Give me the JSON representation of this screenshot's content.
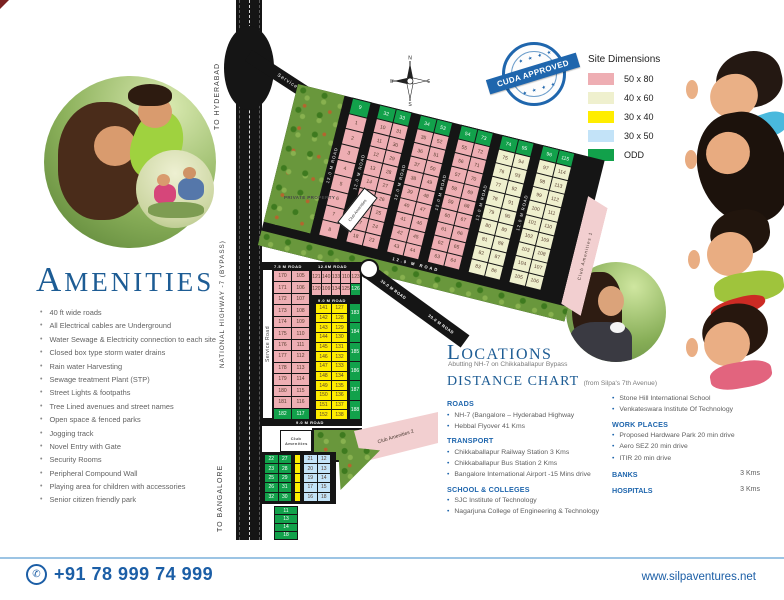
{
  "colors": {
    "pink": "#eeaeb3",
    "cream": "#eff0ce",
    "yellow": "#ffed00",
    "blue": "#c3e3f8",
    "green": "#12a14b",
    "road": "#151515",
    "accent": "#1f66ad",
    "heading": "#1d5c94"
  },
  "badge": {
    "text": "CUDA APPROVED",
    "stars": "★ ★ ★ ★"
  },
  "compass": {
    "n": "N",
    "e": "E",
    "s": "S",
    "w": "W"
  },
  "legend": {
    "title": "Site Dimensions",
    "items": [
      {
        "label": "50 x 80",
        "color": "#eeaeb3"
      },
      {
        "label": "40 x 60",
        "color": "#eff0ce"
      },
      {
        "label": "30 x 40",
        "color": "#ffed00"
      },
      {
        "label": "30 x 50",
        "color": "#c3e3f8"
      },
      {
        "label": "ODD",
        "color": "#12a14b"
      }
    ]
  },
  "amenities": {
    "title": "Amenities",
    "items": [
      "40 ft wide roads",
      "All Electrical cables are Underground",
      "Water Sewage & Electricity connection to each site",
      "Closed box type storm water drains",
      "Rain water Harvesting",
      "Sewage treatment Plant (STP)",
      "Street Lights & footpaths",
      "Tree Lined avenues and street names",
      "Open space & fenced parks",
      "Jogging track",
      "Novel Entry with Gate",
      "Security Rooms",
      "Peripheral Compound Wall",
      "Playing area for children with accessories",
      "Senior citizen friendly park"
    ]
  },
  "locations": {
    "title": "Locations",
    "subtitle": "Abutting NH-7 on Chikkaballapur Bypass"
  },
  "distance_chart": {
    "title": "Distance Chart",
    "subtitle": "(from Silpa's 7th Avenue)",
    "left_sections": [
      {
        "heading": "ROADS",
        "items": [
          "NH-7 (Bangalore – Hyderabad Highway",
          "Hebbal Flyover 41 Kms"
        ]
      },
      {
        "heading": "TRANSPORT",
        "items": [
          "Chikkaballapur Railway Station 3 Kms",
          "Chikkaballapur Bus Station 2 Kms",
          "Bangalore International Airport -15 Mins drive"
        ]
      },
      {
        "heading": "SCHOOL & COLLEGES",
        "items": [
          "SJC Institute of Technology",
          "Nagarjuna College of Engineering & Technology"
        ]
      }
    ],
    "right_sections": [
      {
        "heading": "",
        "items": [
          "Stone Hill International School",
          "Venkateswara Institute Of Technology"
        ]
      },
      {
        "heading": "WORK PLACES",
        "items": [
          "Proposed Hardware Park 20 min drive",
          "Aero SEZ 20 min drive",
          "ITIR  20 min drive"
        ]
      }
    ],
    "rows": [
      {
        "label": "BANKS",
        "value": "3 Kms"
      },
      {
        "label": "HOSPITALS",
        "value": "3 Kms"
      }
    ]
  },
  "map": {
    "labels": {
      "to_hyderabad": "TO HYDERABAD",
      "highway": "NATIONAL HIGHWAY -7 (BYPASS)",
      "to_bangalore": "TO BANGALORE",
      "service_road": "Service Road",
      "private_property": "PRIVATE PROPERTY",
      "club1": "Club Amenities 1",
      "club2": "Club Amenities 2",
      "club": "Club Amenities",
      "road_between": "12.0 M ROAD",
      "road_bottom_strip": "12.0 M ROAD",
      "road_top_a": "7.5 M ROAD",
      "road_top_b": "12.0M ROAD",
      "road_mid": "9.0 M ROAD",
      "road_low": "9.0 M ROAD",
      "road_diag": "30.0 M ROAD"
    },
    "upper_columns": [
      {
        "w": 20,
        "color": "pink",
        "head": [
          "9"
        ],
        "rows": [
          [
            "1"
          ],
          [
            "2"
          ],
          [
            "3"
          ],
          [
            "4"
          ],
          [
            "5"
          ],
          [
            "6"
          ],
          [
            "7"
          ],
          [
            "8"
          ]
        ]
      },
      {
        "w": 34,
        "color": "pink",
        "head": [
          "32",
          "33"
        ],
        "rows": [
          [
            "10",
            "31"
          ],
          [
            "11",
            "30"
          ],
          [
            "12",
            "29"
          ],
          [
            "13",
            "28"
          ],
          [
            "14",
            "27"
          ],
          [
            "15",
            "26"
          ],
          [
            "16",
            "25"
          ],
          [
            "17",
            "24"
          ],
          [
            "18",
            "23"
          ]
        ]
      },
      {
        "w": 34,
        "color": "pink",
        "head": [
          "34",
          "53"
        ],
        "rows": [
          [
            "35",
            "52"
          ],
          [
            "36",
            "51"
          ],
          [
            "37",
            "50"
          ],
          [
            "38",
            "49"
          ],
          [
            "39",
            "48"
          ],
          [
            "40",
            "47"
          ],
          [
            "41",
            "46"
          ],
          [
            "42",
            "45"
          ],
          [
            "43",
            "44"
          ]
        ]
      },
      {
        "w": 34,
        "color": "pink",
        "head": [
          "54",
          "73"
        ],
        "rows": [
          [
            "55",
            "72"
          ],
          [
            "56",
            "71"
          ],
          [
            "57",
            "70"
          ],
          [
            "58",
            "69"
          ],
          [
            "59",
            "68"
          ],
          [
            "60",
            "67"
          ],
          [
            "61",
            "66"
          ],
          [
            "62",
            "65"
          ],
          [
            "63",
            "64"
          ]
        ]
      },
      {
        "w": 34,
        "color": "cream",
        "head": [
          "74",
          "95"
        ],
        "rows": [
          [
            "75",
            "94"
          ],
          [
            "76",
            "93"
          ],
          [
            "77",
            "92"
          ],
          [
            "78",
            "91"
          ],
          [
            "79",
            "90"
          ],
          [
            "80",
            "89"
          ],
          [
            "81",
            "88"
          ],
          [
            "82",
            "87"
          ],
          [
            "83",
            "86"
          ]
        ]
      },
      {
        "w": 34,
        "color": "cream",
        "head": [
          "96",
          "115"
        ],
        "rows": [
          [
            "97",
            "114"
          ],
          [
            "98",
            "113"
          ],
          [
            "99",
            "112"
          ],
          [
            "100",
            "111"
          ],
          [
            "101",
            "110"
          ],
          [
            "102",
            "109"
          ],
          [
            "103",
            "108"
          ],
          [
            "104",
            "107"
          ],
          [
            "105",
            "106"
          ]
        ]
      }
    ],
    "lower": {
      "pink_rows": [
        [
          "170",
          "105"
        ],
        [
          "171",
          "106"
        ],
        [
          "172",
          "107"
        ],
        [
          "173",
          "108"
        ],
        [
          "174",
          "109"
        ],
        [
          "175",
          "110"
        ],
        [
          "176",
          "111"
        ],
        [
          "177",
          "112"
        ],
        [
          "178",
          "113"
        ],
        [
          "179",
          "114"
        ],
        [
          "180",
          "115"
        ],
        [
          "181",
          "116"
        ],
        [
          "182",
          "117"
        ]
      ],
      "mini_rows": [
        [
          "121",
          "140",
          "133",
          "110",
          "123"
        ],
        [
          "120",
          "109",
          "134",
          "125",
          "126"
        ]
      ],
      "yellow_rows": [
        [
          "141",
          "127"
        ],
        [
          "142",
          "128"
        ],
        [
          "143",
          "129"
        ],
        [
          "144",
          "130"
        ],
        [
          "145",
          "131"
        ],
        [
          "146",
          "132"
        ],
        [
          "147",
          "133"
        ],
        [
          "148",
          "134"
        ],
        [
          "149",
          "135"
        ],
        [
          "150",
          "136"
        ],
        [
          "151",
          "137"
        ],
        [
          "152",
          "138"
        ]
      ],
      "green_col": [
        [
          "183"
        ],
        [
          "184"
        ],
        [
          "185"
        ],
        [
          "186"
        ],
        [
          "187"
        ],
        [
          "188"
        ]
      ],
      "cluster_green": [
        [
          "22",
          "27"
        ],
        [
          "23",
          "28"
        ],
        [
          "25",
          "29"
        ],
        [
          "26",
          "31"
        ],
        [
          "32",
          "30"
        ]
      ],
      "cluster_blue": [
        [
          "21",
          "12"
        ],
        [
          "20",
          "13"
        ],
        [
          "19",
          "14"
        ],
        [
          "17",
          "15"
        ],
        [
          "16",
          "18"
        ]
      ],
      "tail_green": [
        [
          "11"
        ],
        [
          "13"
        ],
        [
          "14"
        ],
        [
          "18"
        ]
      ]
    }
  },
  "footer": {
    "phone_icon": "✆",
    "phone": "+91 78 999 74 999",
    "website": "www.silpaventures.net"
  }
}
